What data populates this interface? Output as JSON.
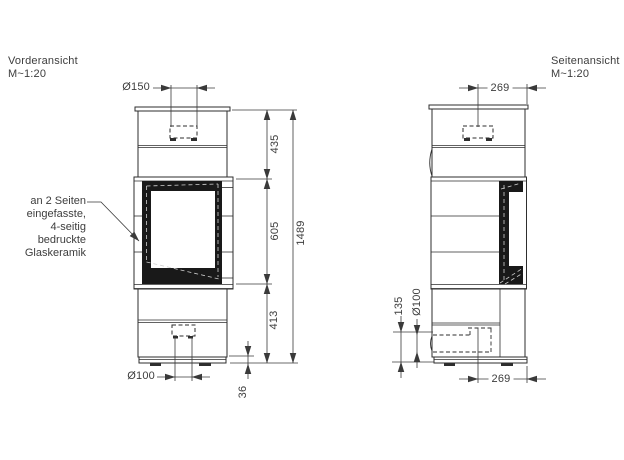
{
  "front_view": {
    "title": "Vorderansicht",
    "scale": "M~1:20",
    "annotation": [
      "an 2 Seiten",
      "eingefasste,",
      "4-seitig",
      "bedruckte",
      "Glaskeramik"
    ],
    "dimensions": {
      "flue_diameter": "Ø150",
      "upper_section_height": "435",
      "firebox_section_height": "605",
      "lower_section_height": "413",
      "total_height": "1489",
      "air_inlet_diameter": "Ø100",
      "base_height": "36"
    }
  },
  "side_view": {
    "title": "Seitenansicht",
    "scale": "M~1:20",
    "dimensions": {
      "flue_center_offset": "269",
      "air_inlet_diameter": "Ø100",
      "air_inlet_height": "135",
      "depth_offset": "269"
    }
  },
  "colors": {
    "line": "#2e2e2e",
    "dimension": "#444444",
    "glass_fill": "#191919",
    "background": "#ffffff"
  }
}
